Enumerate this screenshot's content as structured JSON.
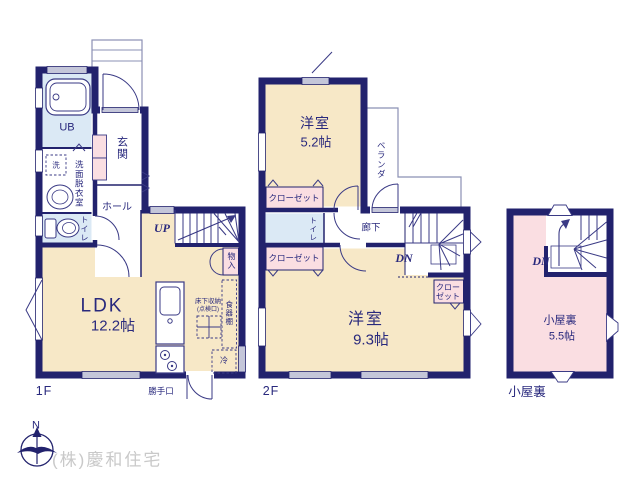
{
  "colors": {
    "wall_navy": "#22226d",
    "room_cream": "#f7e8c7",
    "room_blue": "#dbe9f5",
    "room_pink": "#fadee2",
    "window_gray": "#c4c6d9",
    "text_navy": "#29297d",
    "company_gray": "#c9c9c9"
  },
  "floor1": {
    "caption": "1F",
    "unit_bath": "UB",
    "washer": "洗",
    "washroom": "洗面脱衣室",
    "toilet": "トイレ",
    "entrance": "玄関",
    "hall": "ホール",
    "stairs_up": "UP",
    "storage": "物入",
    "ldk_name": "LDK",
    "ldk_size": "12.2帖",
    "underfloor_line1": "床下収納",
    "underfloor_line2": "(点検口)",
    "cupboard": "食器棚",
    "fridge": "冷",
    "back_door": "勝手口"
  },
  "floor2": {
    "caption": "2F",
    "room_a_name": "洋室",
    "room_a_size": "5.2帖",
    "veranda": "ベランダ",
    "closet_a": "クローゼット",
    "toilet": "トイレ",
    "corridor": "廊下",
    "stairs_down": "DN",
    "closet_b": "クローゼット",
    "closet_c_line1": "クロー",
    "closet_c_line2": "ゼット",
    "room_b_name": "洋室",
    "room_b_size": "9.3帖"
  },
  "attic": {
    "caption": "小屋裏",
    "stairs_down": "DN",
    "room_name": "小屋裏",
    "room_size": "5.5帖"
  },
  "footer": {
    "compass_north": "N",
    "company": "(株)慶和住宅"
  }
}
